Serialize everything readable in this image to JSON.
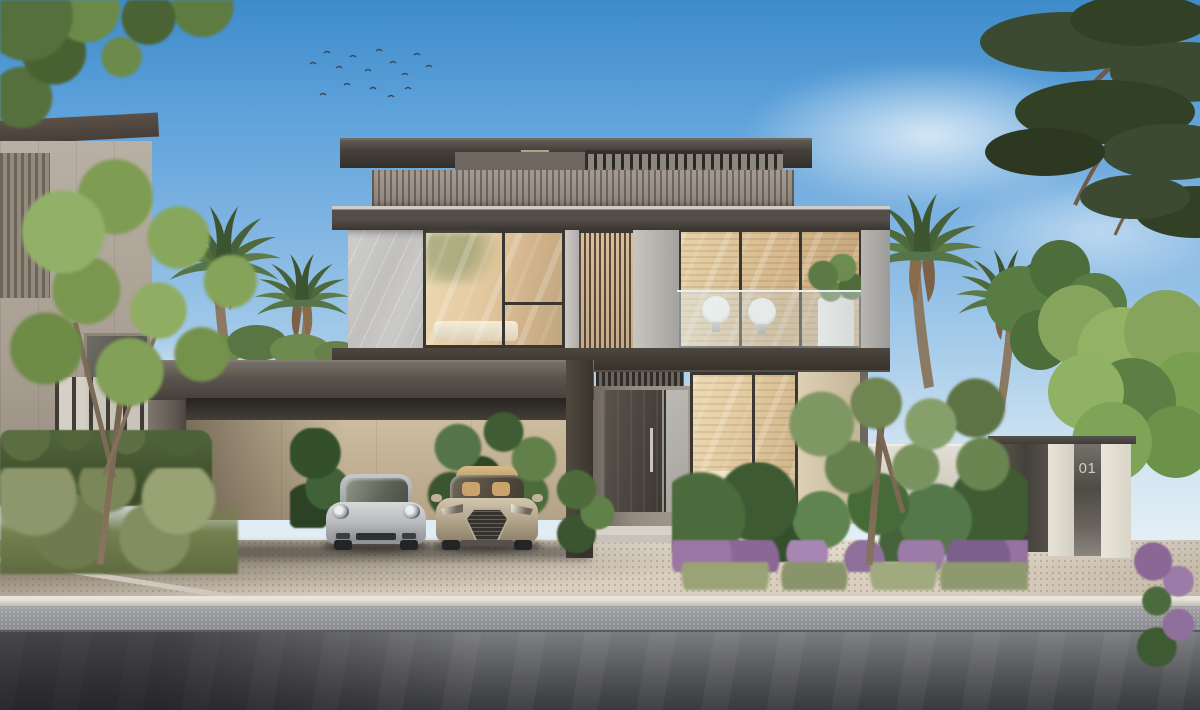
{
  "scene": {
    "description": "Photorealistic daytime exterior rendering of a modern two-storey villa with rooftop pergola terrace, louvered parapet, warm-lit glass facade, a dark concrete carport sheltering two sports cars, tropical landscaping with palms and flowering beds, and an asphalt street in the foreground",
    "sky": "clear blue sky with a distant flock of birds and wispy clouds"
  },
  "gate": {
    "house_number": "01"
  },
  "vehicles": [
    {
      "name": "silver sports coupe",
      "color": "#c6c8ca"
    },
    {
      "name": "champagne sports coupe",
      "color": "#cbbfa8"
    }
  ],
  "palette": {
    "sky_top": "#3e8bcb",
    "sky_horizon": "#e6f0f6",
    "roof_fascia": "#47413c",
    "louver_band": "#9a9088",
    "marble_cladding": "#c8c7c5",
    "window_glow": "#e0c79c",
    "carport_concrete": "#5e5852",
    "interior_beige_wall": "#cdbd9f",
    "foliage_dark": "#3f5230",
    "foliage_light": "#8aa65e",
    "flower_accent": "#9b79a6",
    "paver": "#dacfbe",
    "asphalt": "#47484b",
    "gate_panel": "#4e4a44",
    "gate_pier": "#e7e3d8"
  }
}
